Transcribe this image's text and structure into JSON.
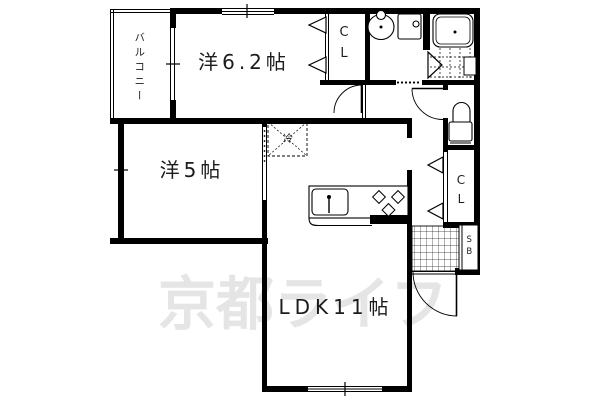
{
  "floorplan": {
    "watermark": {
      "text": "京都ライフ",
      "color": "#e5e5e5"
    },
    "labels": {
      "balcony": "バルコニー",
      "room_6_2": "洋6.2帖",
      "room_5": "洋5帖",
      "ldk": "LDK11帖",
      "closet_top": "CL",
      "closet_right": "CL",
      "shoe_box": "SB",
      "refrigerator": "冷"
    },
    "fixtures": [
      "washbasin",
      "washing-machine-pan",
      "bathtub",
      "bath-tile-floor",
      "toilet",
      "kitchen-sink",
      "gas-stove",
      "entrance-tile",
      "shoe-box"
    ],
    "colors": {
      "wall": "#000000",
      "background": "#ffffff",
      "label": "#1c1c1c",
      "watermark": "#e5e5e5"
    }
  }
}
